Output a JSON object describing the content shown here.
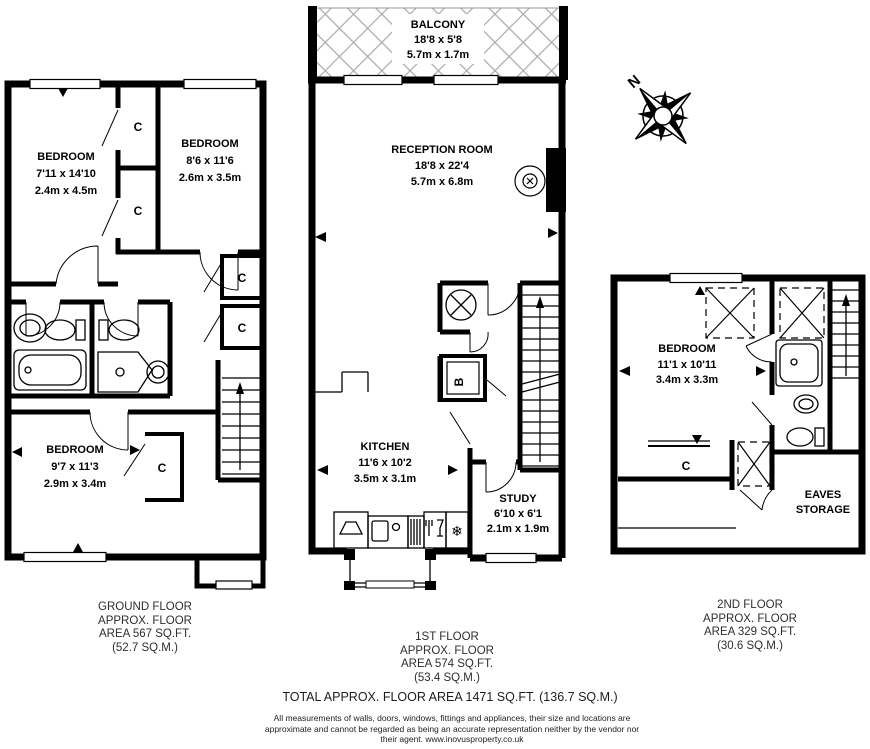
{
  "plans": {
    "ground": {
      "floor_label": [
        "GROUND FLOOR",
        "APPROX. FLOOR",
        "AREA 567 SQ.FT.",
        "(52.7 SQ.M.)"
      ],
      "rooms": {
        "bedroom_front": {
          "name": "BEDROOM",
          "imperial": "7'11 x 14'10",
          "metric": "2.4m x 4.5m"
        },
        "bedroom_mid": {
          "name": "BEDROOM",
          "imperial": "8'6 x 11'6",
          "metric": "2.6m x 3.5m"
        },
        "bedroom_back": {
          "name": "BEDROOM",
          "imperial": "9'7 x 11'3",
          "metric": "2.9m x 3.4m"
        }
      },
      "closet_label": "C"
    },
    "first": {
      "floor_label": [
        "1ST FLOOR",
        "APPROX. FLOOR",
        "AREA 574 SQ.FT.",
        "(53.4 SQ.M.)"
      ],
      "rooms": {
        "balcony": {
          "name": "BALCONY",
          "imperial": "18'8 x 5'8",
          "metric": "5.7m x 1.7m"
        },
        "reception": {
          "name": "RECEPTION ROOM",
          "imperial": "18'8 x 22'4",
          "metric": "5.7m x 6.8m"
        },
        "kitchen": {
          "name": "KITCHEN",
          "imperial": "11'6 x 10'2",
          "metric": "3.5m x 3.1m"
        },
        "study": {
          "name": "STUDY",
          "imperial": "6'10 x 6'1",
          "metric": "2.1m x 1.9m"
        }
      },
      "boiler_label": "B"
    },
    "second": {
      "floor_label": [
        "2ND FLOOR",
        "APPROX. FLOOR",
        "AREA 329 SQ.FT.",
        "(30.6 SQ.M.)"
      ],
      "rooms": {
        "bedroom": {
          "name": "BEDROOM",
          "imperial": "11'1 x 10'11",
          "metric": "3.4m x 3.3m"
        },
        "eaves": {
          "name_line1": "EAVES",
          "name_line2": "STORAGE"
        }
      },
      "closet_label": "C"
    }
  },
  "compass": {
    "north": "N"
  },
  "footer": {
    "total": "TOTAL APPROX. FLOOR AREA 1471 SQ.FT. (136.7 SQ.M.)",
    "disclaimer": [
      "All measurements of walls, doors, windows, fittings and appliances, their size and locations are",
      "approximate and cannot be regarded as being an accurate representation neither by the vendor nor",
      "their agent.  www.inovusproperty.co.uk"
    ]
  }
}
